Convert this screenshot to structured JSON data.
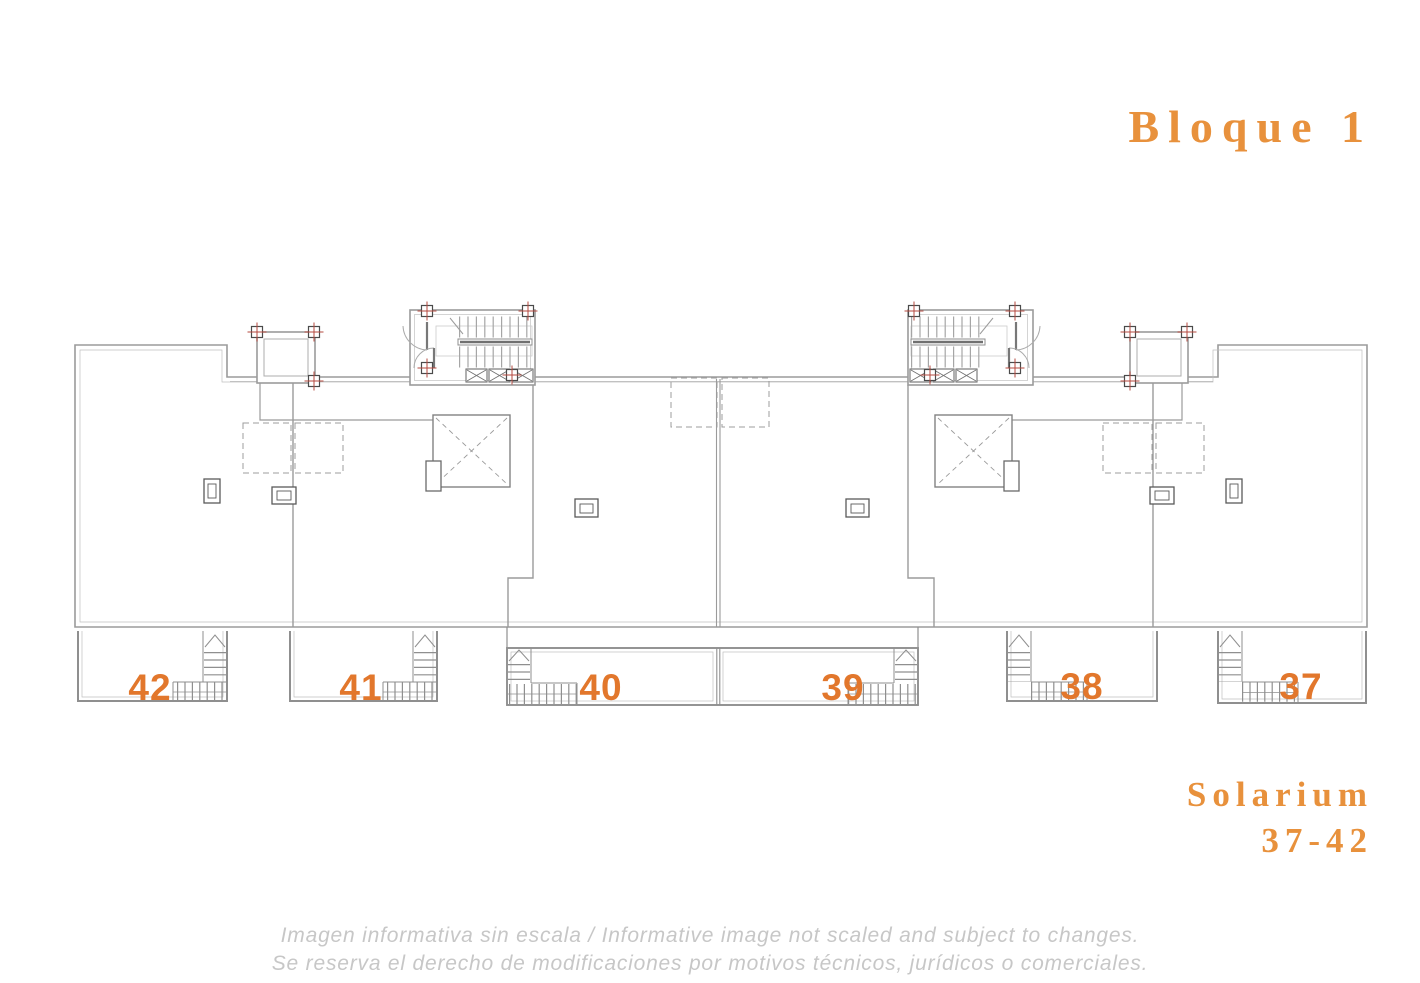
{
  "header": {
    "title": "Bloque 1"
  },
  "side_label": {
    "line1": "Solarium",
    "line2": "37-42"
  },
  "footer": {
    "line1": "Imagen informativa sin escala /  Informative image not scaled and subject to changes.",
    "line2": "Se reserva el derecho de modificaciones por motivos técnicos, jurídicos o comerciales."
  },
  "plan": {
    "type": "floor-plan",
    "block": "Bloque 1",
    "level": "Solarium",
    "unit_range": "37-42",
    "units": [
      {
        "number": "42"
      },
      {
        "number": "41"
      },
      {
        "number": "40"
      },
      {
        "number": "39"
      },
      {
        "number": "38"
      },
      {
        "number": "37"
      }
    ],
    "features": [
      "stair-core-left",
      "stair-core-right",
      "elevator-shaft-left",
      "elevator-shaft-right",
      "roof-structure-left",
      "roof-structure-right",
      "dashed-pergolas",
      "terrace-stairs",
      "roof-drains"
    ]
  },
  "colors": {
    "accent_orange": "#e8913c",
    "unit_number_orange": "#e2772c",
    "wall_gray": "#9b9b9b",
    "detail_gray": "#6f6f6f",
    "column_red": "#b5493f",
    "disclaimer_gray": "#c7c7c7",
    "background": "#ffffff"
  }
}
